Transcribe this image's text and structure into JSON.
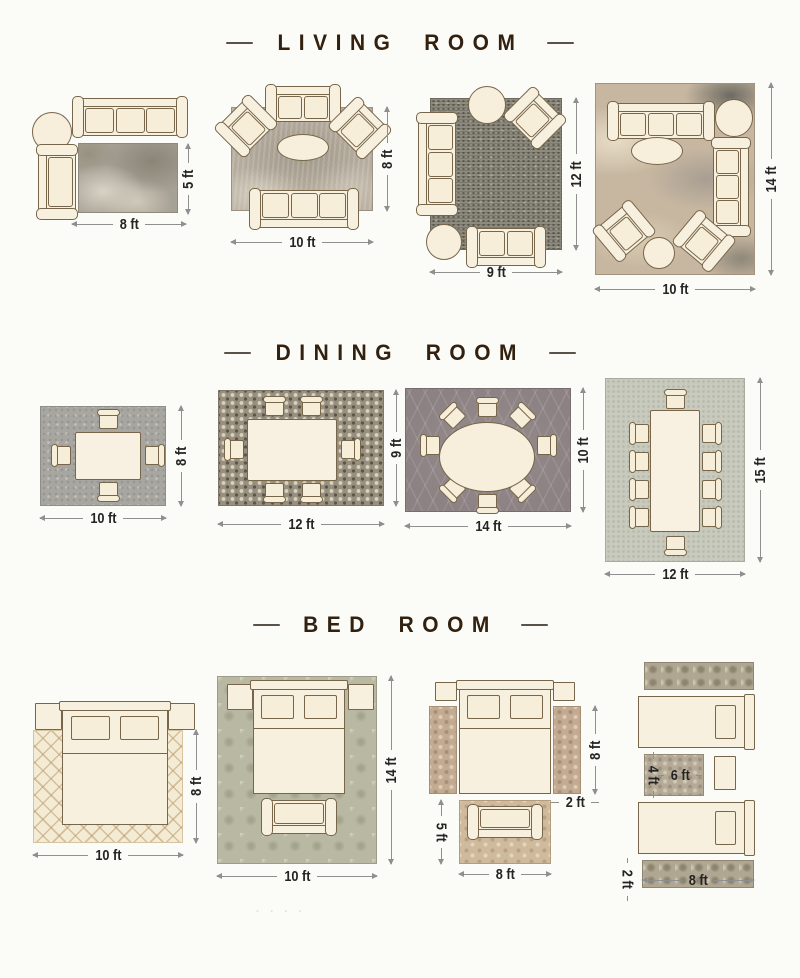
{
  "sections": {
    "living": {
      "title": "LIVING ROOM"
    },
    "dining": {
      "title": "DINING ROOM"
    },
    "bed": {
      "title": "BED ROOM"
    }
  },
  "living_room": {
    "layouts": [
      {
        "width": "8 ft",
        "height": "5 ft",
        "rug": "mottled gray-green",
        "furniture": "3-seat sofa, round side table, chaise"
      },
      {
        "width": "10 ft",
        "height": "8 ft",
        "rug": "heathered gray",
        "furniture": "loveseat, 2 angled armchairs, oval coffee table, 3-seat sofa"
      },
      {
        "width": "9 ft",
        "height": "12 ft",
        "rug": "dark distressed gray",
        "furniture": "3-seat sofa, armchair, 2 round side tables, loveseat"
      },
      {
        "width": "10 ft",
        "height": "14 ft",
        "rug": "abstract beige-taupe",
        "furniture": "two 3-seat sofas, 2 armchairs, oval coffee table, 2 round side tables"
      }
    ]
  },
  "dining_room": {
    "layouts": [
      {
        "width": "10 ft",
        "height": "8 ft",
        "seats": "4",
        "rug": "solid gray"
      },
      {
        "width": "12 ft",
        "height": "9 ft",
        "seats": "6",
        "rug": "mosaic dot"
      },
      {
        "width": "14 ft",
        "height": "10 ft",
        "seats": "8",
        "rug": "dark trellis, oval table"
      },
      {
        "width": "12 ft",
        "height": "15 ft",
        "seats": "10",
        "rug": "pale sage, long table"
      }
    ]
  },
  "bed_room": {
    "layouts": [
      {
        "width": "10 ft",
        "height": "8 ft",
        "rug": "cream lattice"
      },
      {
        "width": "10 ft",
        "height": "14 ft",
        "rug": "sage damask, bench at foot"
      },
      {
        "bed_side_height": "8 ft",
        "runner_width": "2 ft",
        "foot_rug_height": "5 ft",
        "foot_rug_width": "8 ft",
        "rug": "tan floral runners + foot rug"
      },
      {
        "mid_rug_height": "4 ft",
        "mid_rug_width": "6 ft",
        "runner_height": "2 ft",
        "width": "8 ft",
        "rug": "ornate runners between twin beds"
      }
    ]
  },
  "decor": {
    "faint_marks": ". . . ."
  },
  "colors": {
    "background": "#fbfbf8",
    "furniture_fill": "#f8f0df",
    "furniture_outline": "#77664a",
    "title_text": "#33210f",
    "dimension_text": "#262422",
    "dimension_line": "#8f8f8f"
  }
}
